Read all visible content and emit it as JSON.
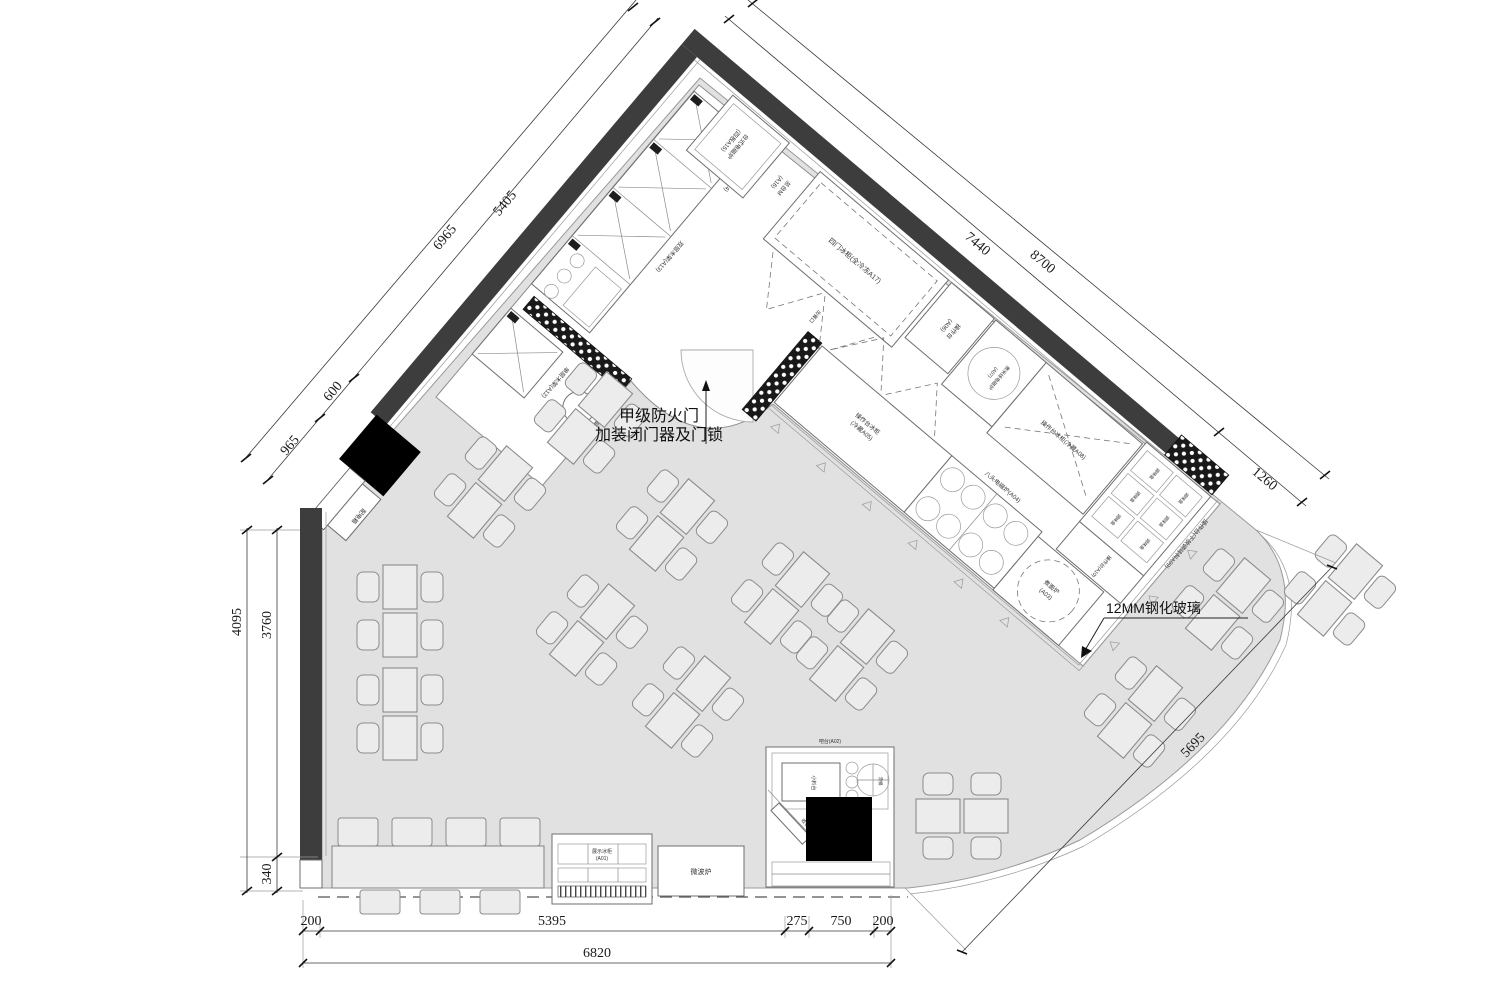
{
  "title": "餐厅厨房平面布置图",
  "dimensions": {
    "top_left": {
      "outer": "6965",
      "seg1": "5405",
      "seg2": "600",
      "seg3": "965"
    },
    "top_right": {
      "inner": "7440",
      "outer": "8700",
      "end": "1260"
    },
    "left": {
      "outer": "4095",
      "seg1": "3760",
      "seg2": "340"
    },
    "bottom": {
      "seg1": "200",
      "seg2": "5395",
      "seg3": "275",
      "seg4": "750",
      "seg5": "200",
      "total": "6820"
    },
    "right": {
      "storefront": "5695"
    }
  },
  "annotations": {
    "fire_door_1": "甲级防火门",
    "fire_door_2": "加装闭门器及门锁",
    "tempered_glass": "12MM钢化玻璃",
    "distribution_box": "配电箱",
    "service_pass": "出餐口"
  },
  "equipment": {
    "display_freezer_1": "展示冰柜",
    "display_freezer_2": "(A01)",
    "microwave": "微波炉",
    "bar_counter": "吧台(A02)",
    "condiment_station": "小料台",
    "cash_register": "收银机",
    "soup_pot": "汤桶",
    "noodle_stove_1": "煮面炉",
    "noodle_stove_2": "(A03)",
    "eight_head_stove": "八头电磁炉(A04)",
    "island_fridge_1": "操作台冰柜",
    "island_fridge_2": "(冷藏A05)",
    "worktop_a06_1": "操作台",
    "worktop_a06_2": "(A06)",
    "rice_noodle_stove_1": "煮米线电磁炉",
    "rice_noodle_stove_2": "(A07)",
    "worktop_fridge_a08": "操作台冰柜(冷藏A08)",
    "worktop_seasoning_a09": "操作台(下放调味料A09)",
    "worktop_a10": "操作台(A10)",
    "waste_table_a11": "残食台(A11)",
    "single_shelf_a12": "单层木架(A12)",
    "double_shelf_a13": "双层木架(A13)",
    "hanging_shelf_a14": "单层吊隔板(A14)",
    "induction_cooker_1": "台式电磁炉",
    "induction_cooker_2": "(四板A15)",
    "main_counter_1": "总台M",
    "main_counter_2": "(A16)",
    "four_door_freezer": "四门冰柜(全冷冻A17)",
    "condiment_box": "调味盒"
  }
}
